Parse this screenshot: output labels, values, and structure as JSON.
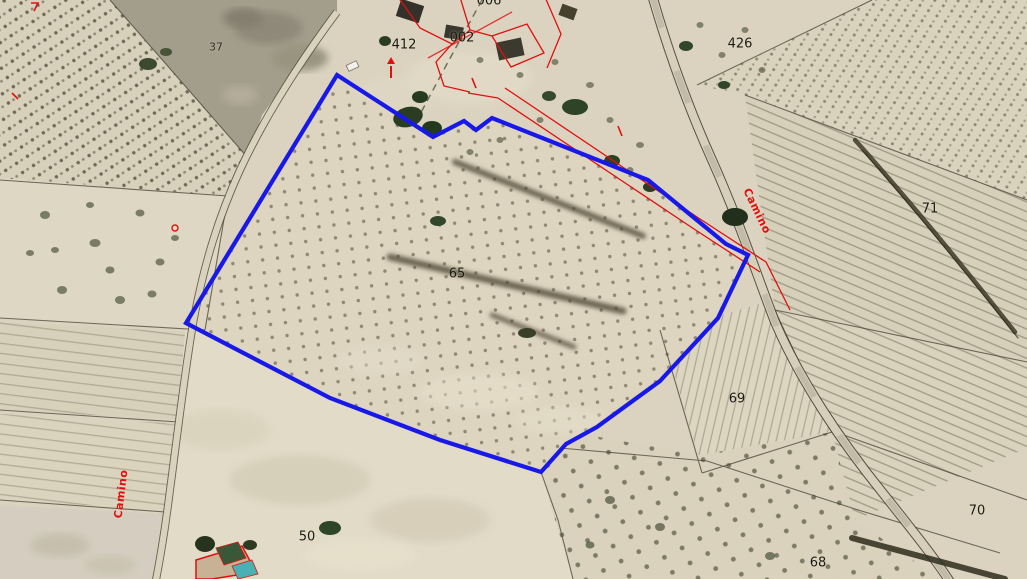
{
  "map": {
    "kind": "cadastral-aerial-view",
    "colors": {
      "highlight_blue": "#1818e8",
      "cadastral_red": "#e01010",
      "boundary_dark": "#464232",
      "base_ground": "#dbd3bf"
    },
    "highlighted_parcel": "65"
  },
  "parcel_labels": [
    {
      "id": "parcel-65",
      "text": "65"
    },
    {
      "id": "parcel-426",
      "text": "426"
    },
    {
      "id": "parcel-71",
      "text": "71"
    },
    {
      "id": "parcel-69",
      "text": "69"
    },
    {
      "id": "parcel-70",
      "text": "70"
    },
    {
      "id": "parcel-68",
      "text": "68"
    },
    {
      "id": "parcel-50",
      "text": "50"
    },
    {
      "id": "parcel-37",
      "text": "37"
    }
  ],
  "building_labels": [
    {
      "id": "building-002",
      "text": "002"
    },
    {
      "id": "building-412",
      "text": "412"
    },
    {
      "id": "building-006",
      "text": "006"
    }
  ],
  "road_labels": [
    {
      "id": "camino-east",
      "text": "Camino"
    },
    {
      "id": "camino-west",
      "text": "Camino"
    }
  ]
}
